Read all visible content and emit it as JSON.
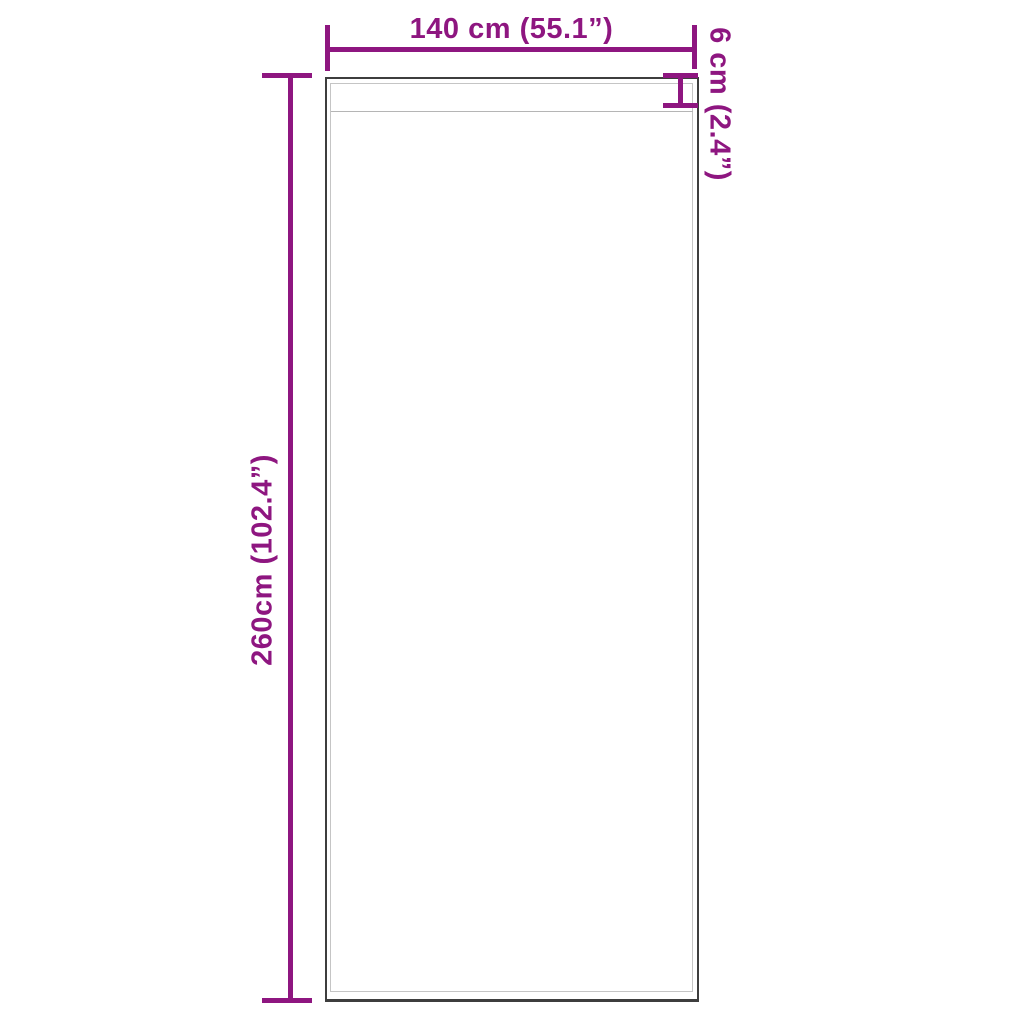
{
  "diagram": {
    "type": "product-dimension-diagram",
    "subject": "curtain-panel-with-rod-pocket",
    "colors": {
      "background": "#ffffff",
      "dimension": "#8e1680",
      "outline": "#3e3e3e",
      "inner_edge": "#c5c5c5",
      "seam": "#b5b5b5"
    },
    "dimensions": {
      "width_label": "140 cm (55.1”)",
      "height_label": "260cm (102.4”)",
      "pocket_label": "6 cm (2.4”)"
    }
  }
}
